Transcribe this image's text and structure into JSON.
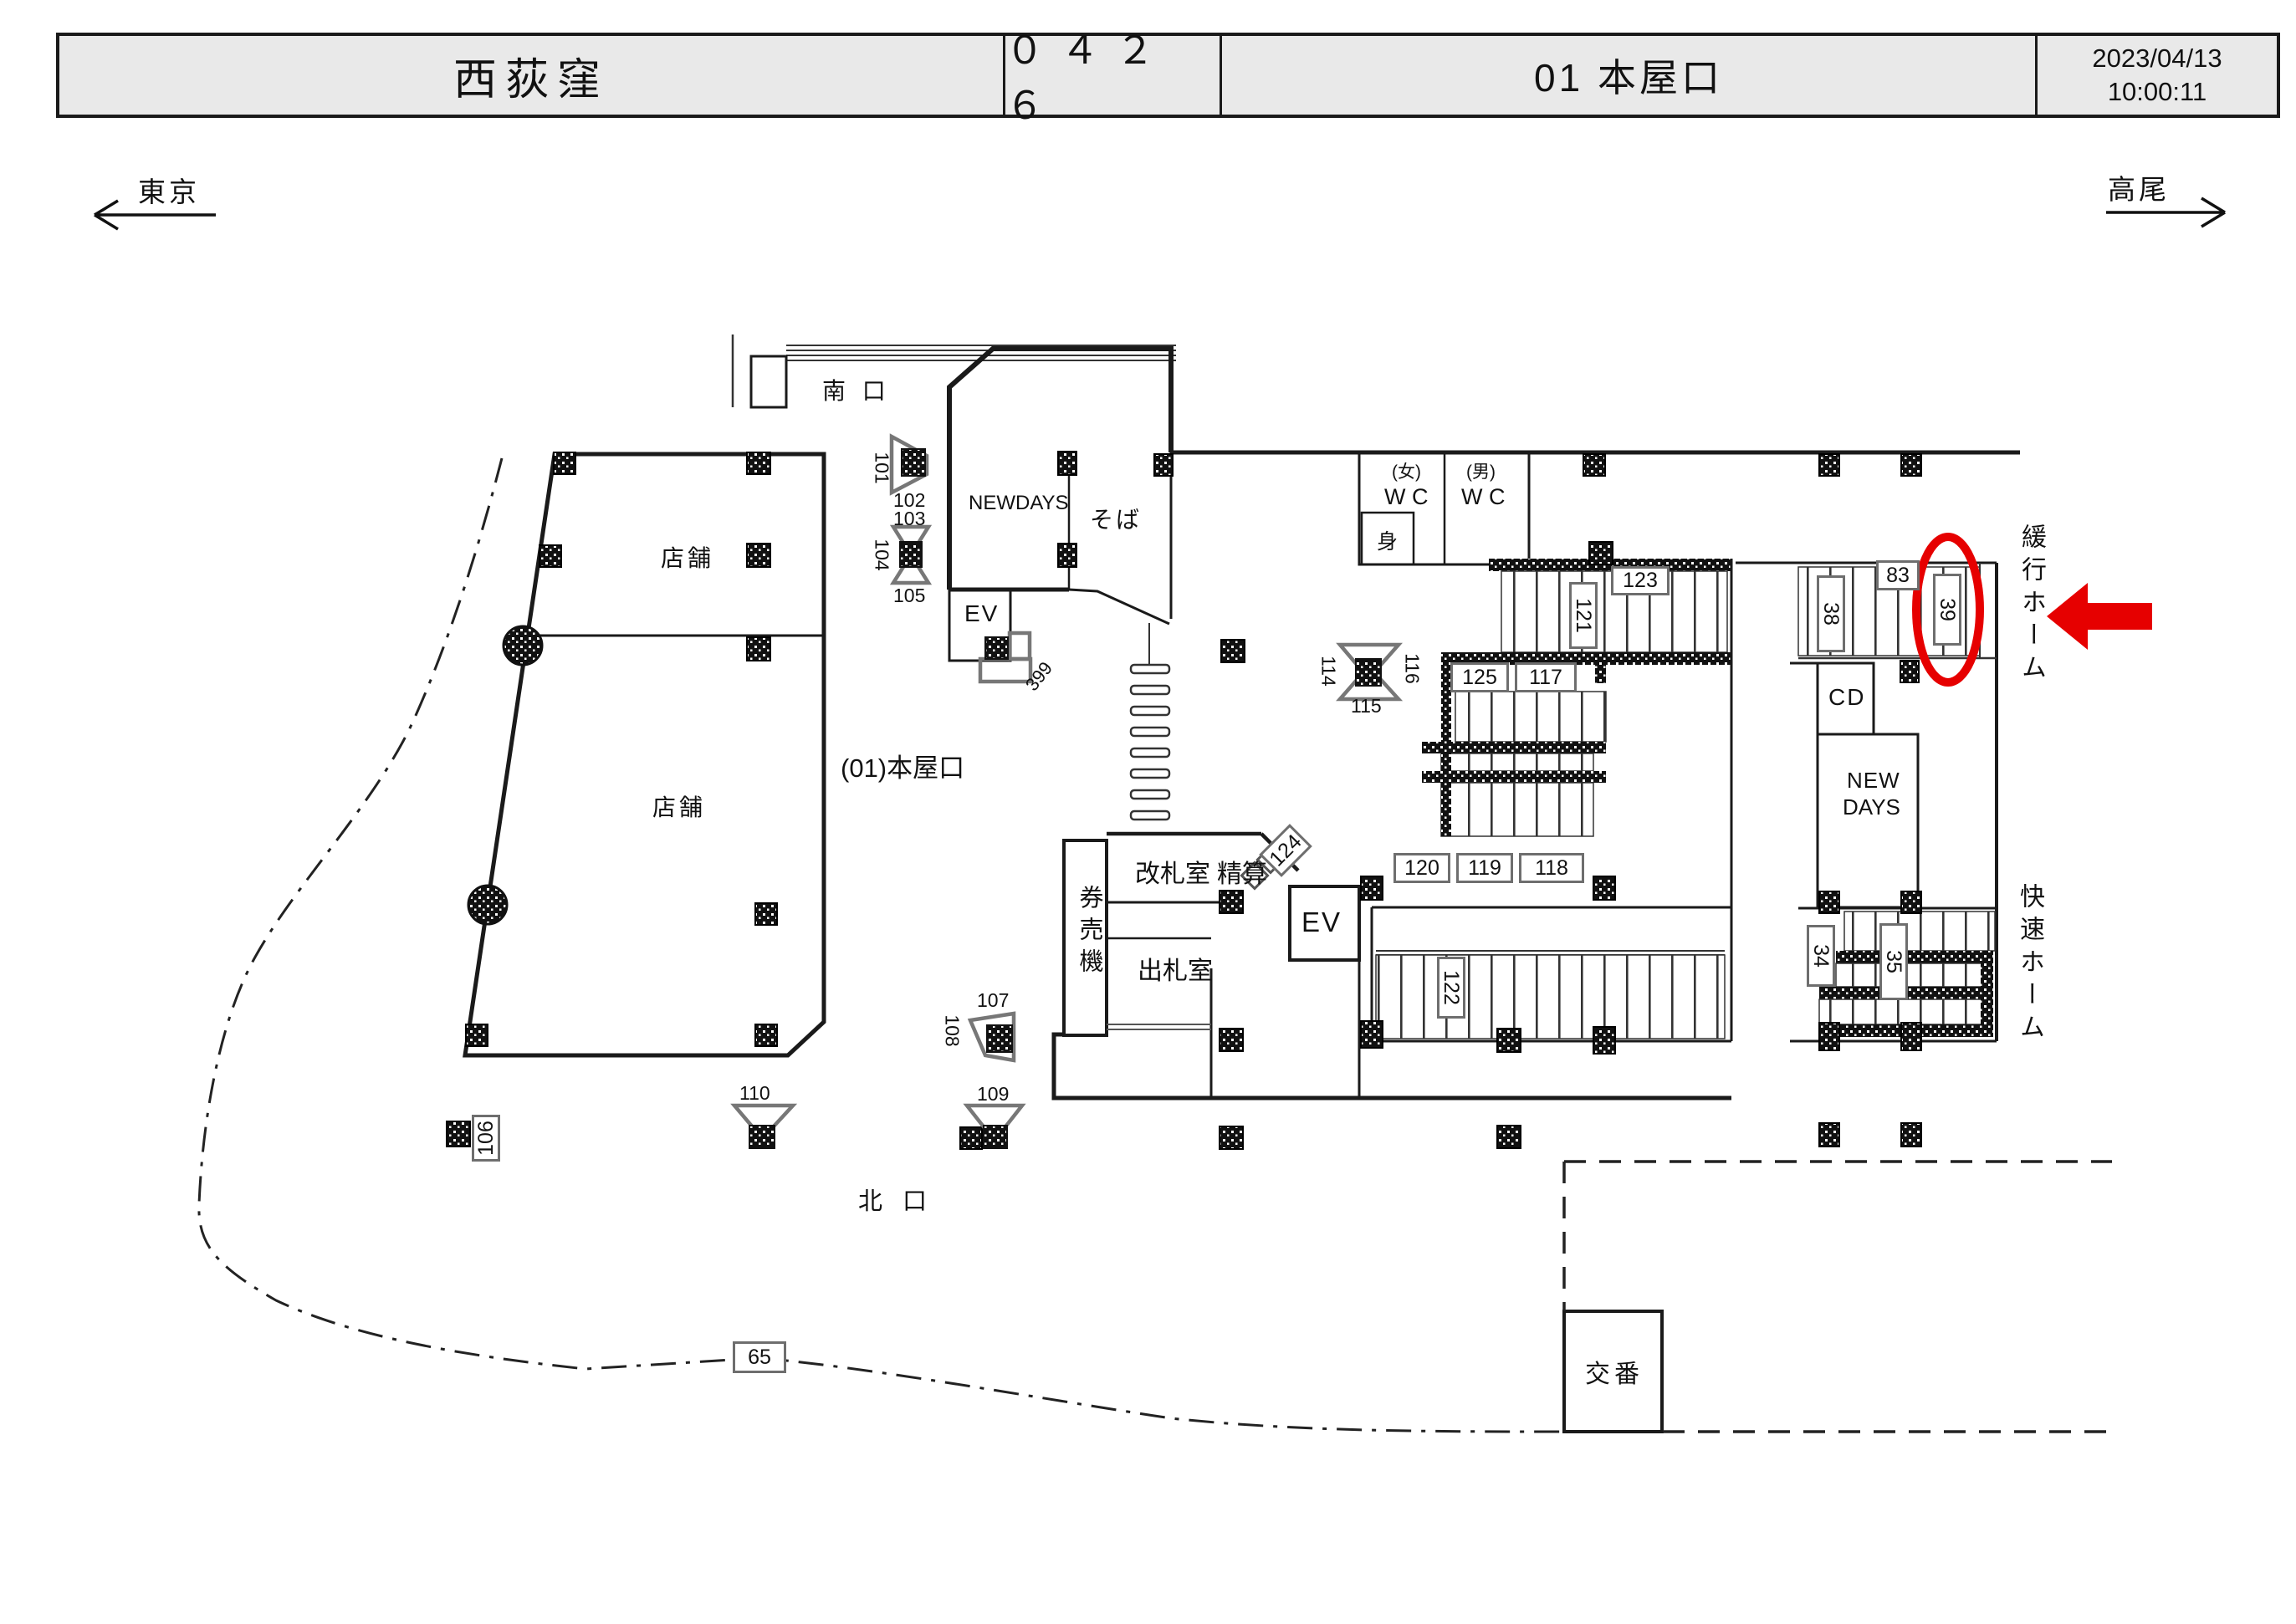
{
  "header": {
    "station_name": "西荻窪",
    "station_code": "０４２６",
    "map_title": "01 本屋口",
    "date": "2023/04/13",
    "time": "10:00:11"
  },
  "directions": {
    "west": "東京",
    "east": "高尾"
  },
  "areas": {
    "south_exit": "南 口",
    "north_exit": "北 口",
    "map_label": "(01)本屋口",
    "newdays_main": "NEWDAYS",
    "soba": "そば",
    "wc_women_tag": "(女)",
    "wc_women": "W C",
    "wc_men_tag": "(男)",
    "wc_men": "W C",
    "fitting_room": "身",
    "elevator_upper": "EV",
    "elevator_lower": "EV",
    "gate_office": "改札室",
    "fare_adjustment": "精算",
    "ticket_machines": "券売機",
    "ticket_office": "出札室",
    "cd_corner": "CD",
    "newdays_platform_1": "NEW",
    "newdays_platform_2": "DAYS",
    "police_box": "交番",
    "shop_upper": "店舗",
    "shop_lower": "店舗",
    "local_platform": "緩行ホーム",
    "rapid_platform": "快速ホーム"
  },
  "cameras": {
    "c101": "101",
    "c102": "102",
    "c103": "103",
    "c104": "104",
    "c105": "105",
    "c106": "106",
    "c107": "107",
    "c108": "108",
    "c109": "109",
    "c110": "110",
    "c114": "114",
    "c115": "115",
    "c116": "116",
    "c117": "117",
    "c118": "118",
    "c119": "119",
    "c120": "120",
    "c121": "121",
    "c122": "122",
    "c123": "123",
    "c124": "124",
    "c125": "125",
    "c34": "34",
    "c35": "35",
    "c38": "38",
    "c39": "39",
    "c65": "65",
    "c83": "83",
    "c399": "399"
  },
  "highlight": {
    "circled_camera": "39",
    "circle_color": "#e60000",
    "arrow_color": "#e60000"
  }
}
